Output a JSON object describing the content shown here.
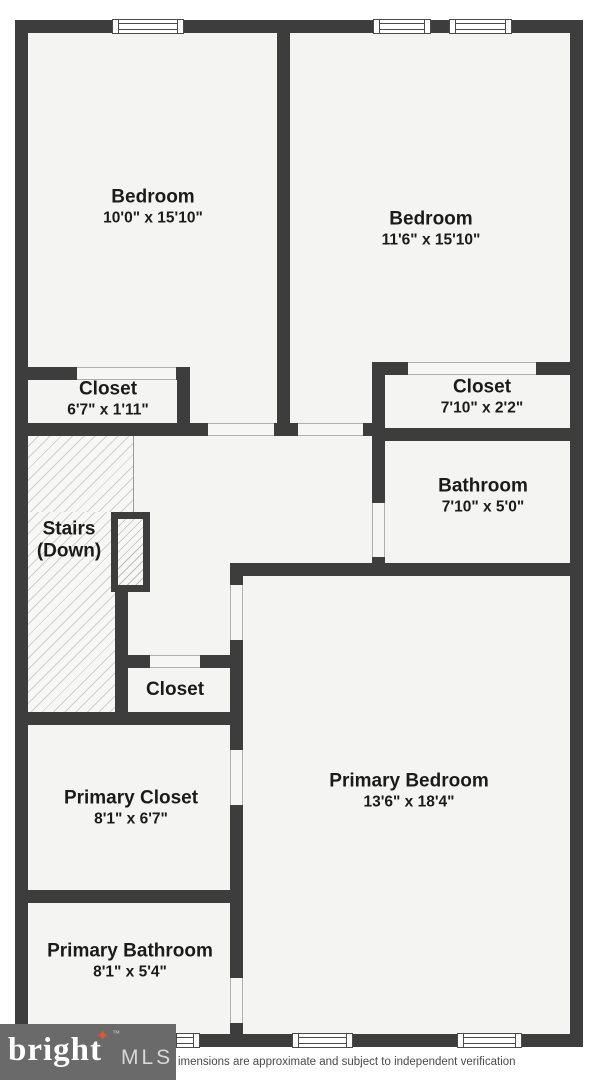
{
  "colors": {
    "wall": "#3d3d3d",
    "floor": "#f4f4f3",
    "hatch_line": "#cfcfcf",
    "text": "#1b1b1b",
    "logo_bg": "#6a6a6a",
    "star_accent": "#e4572e"
  },
  "rooms": [
    {
      "id": "bedroom-1",
      "name": "Bedroom",
      "dims": "10'0\" x 15'10\""
    },
    {
      "id": "bedroom-2",
      "name": "Bedroom",
      "dims": "11'6\" x 15'10\""
    },
    {
      "id": "closet-left",
      "name": "Closet",
      "dims": "6'7\" x 1'11\""
    },
    {
      "id": "closet-right",
      "name": "Closet",
      "dims": "7'10\" x 2'2\""
    },
    {
      "id": "bathroom",
      "name": "Bathroom",
      "dims": "7'10\" x 5'0\""
    },
    {
      "id": "stairs",
      "name": "Stairs",
      "name2": "(Down)"
    },
    {
      "id": "closet-middle",
      "name": "Closet"
    },
    {
      "id": "primary-closet",
      "name": "Primary Closet",
      "dims": "8'1\" x 6'7\""
    },
    {
      "id": "primary-bedroom",
      "name": "Primary Bedroom",
      "dims": "13'6\" x 18'4\""
    },
    {
      "id": "primary-bathroom",
      "name": "Primary Bathroom",
      "dims": "8'1\" x 5'4\""
    }
  ],
  "logo": {
    "brand": "bright",
    "suffix": "MLS",
    "tm": "™",
    "star": "✦"
  },
  "meta": {
    "disclaimer": "imensions are approximate and subject to independent verification"
  }
}
